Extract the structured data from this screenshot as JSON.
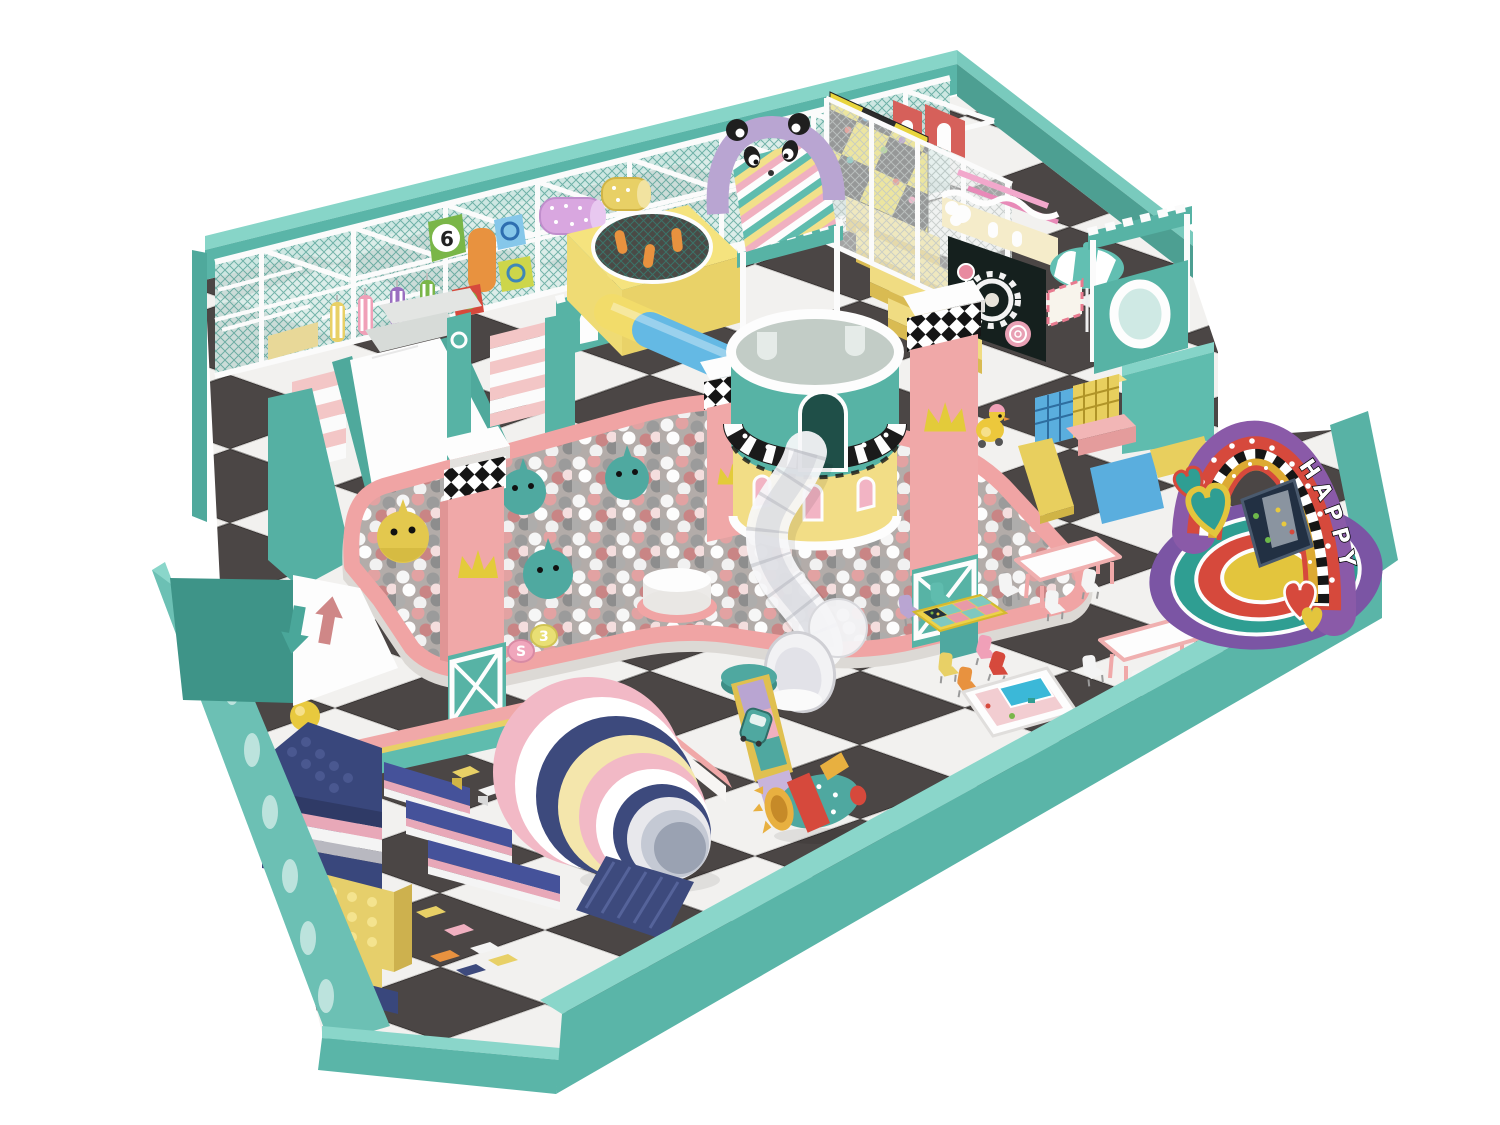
{
  "texts": {
    "happy_sign": "HAPPY",
    "pinwheel_number": "6",
    "candy_check": "✓",
    "candy_letter": "S",
    "candy_number": "3"
  },
  "icons": [
    "panda-face",
    "crown",
    "heart",
    "gear",
    "umbrella",
    "down-arrow",
    "up-arrow",
    "check-mark"
  ],
  "palette": {
    "wall_teal": "#5ab5a8",
    "wall_teal_light": "#8ad6ca",
    "wall_teal_dark": "#3e9488",
    "structure_teal": "#57b3a5",
    "frame_white": "#fbfbfb",
    "net_teal": "#2f8d80",
    "floor_dark": "#4b4645",
    "floor_light": "#f2f1ef",
    "pink": "#f0a8a8",
    "ballpit_border_pink": "#f0a4a4",
    "crown_yellow": "#e3cb3a",
    "platform_yellow": "#f5e37e",
    "lavender": "#b9a5d2",
    "navy": "#3d4a7d",
    "blue": "#5aaede",
    "red": "#d6493c",
    "orange": "#e8923f",
    "green": "#7ab648",
    "stage_purple": "#7b55a4",
    "stage_teal": "#2f9e92",
    "stage_red": "#d6493c",
    "stage_yellow": "#e3c53d",
    "arch_purple": "#8a5aa8",
    "entry_arrow_in": "#cf8787",
    "entry_arrow_out": "#4aa79a"
  }
}
